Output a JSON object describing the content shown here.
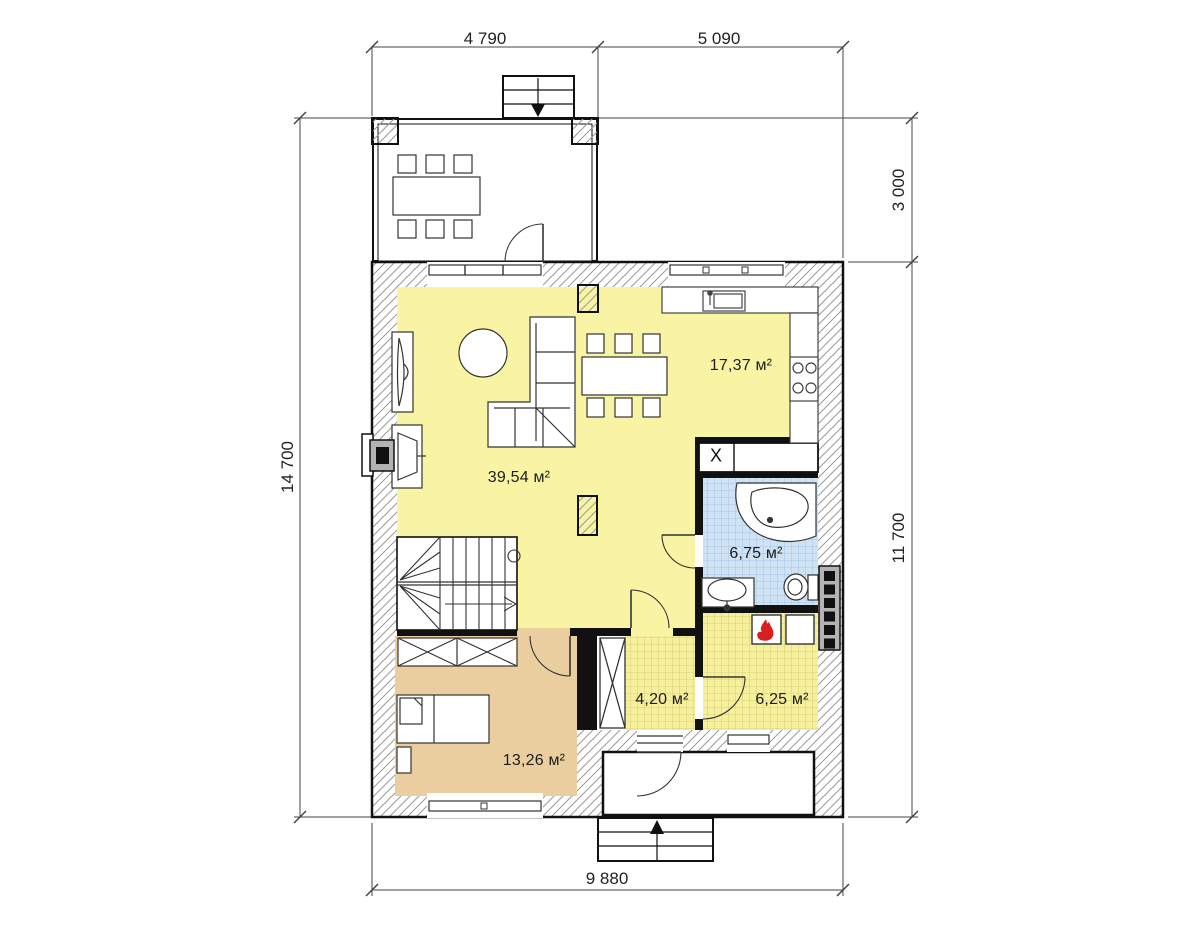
{
  "title": "house-first-floor-plan",
  "rooms": [
    {
      "id": "kitchen",
      "area_label": "17,37 м²"
    },
    {
      "id": "living-room",
      "area_label": "39,54 м²"
    },
    {
      "id": "bathroom",
      "area_label": "6,75 м²"
    },
    {
      "id": "hallway",
      "area_label": "4,20 м²"
    },
    {
      "id": "boiler-room",
      "area_label": "6,25 м²"
    },
    {
      "id": "bedroom",
      "area_label": "13,26 м²"
    }
  ],
  "dimensions": {
    "top_left": "4 790",
    "top_right": "5 090",
    "right_top": "3 000",
    "right_bottom": "11 700",
    "left": "14 700",
    "bottom": "9 880"
  },
  "markers": {
    "closet": "X"
  },
  "colors": {
    "living_floor": "#f8f4a4",
    "tile_yellow": "#f6f09c",
    "bathroom_floor": "#cfe3f5",
    "bedroom_floor": "#eaceA0",
    "flame_red": "#d81e1e",
    "chimney_gray": "#b3b3b3",
    "wall_line": "#111111"
  }
}
